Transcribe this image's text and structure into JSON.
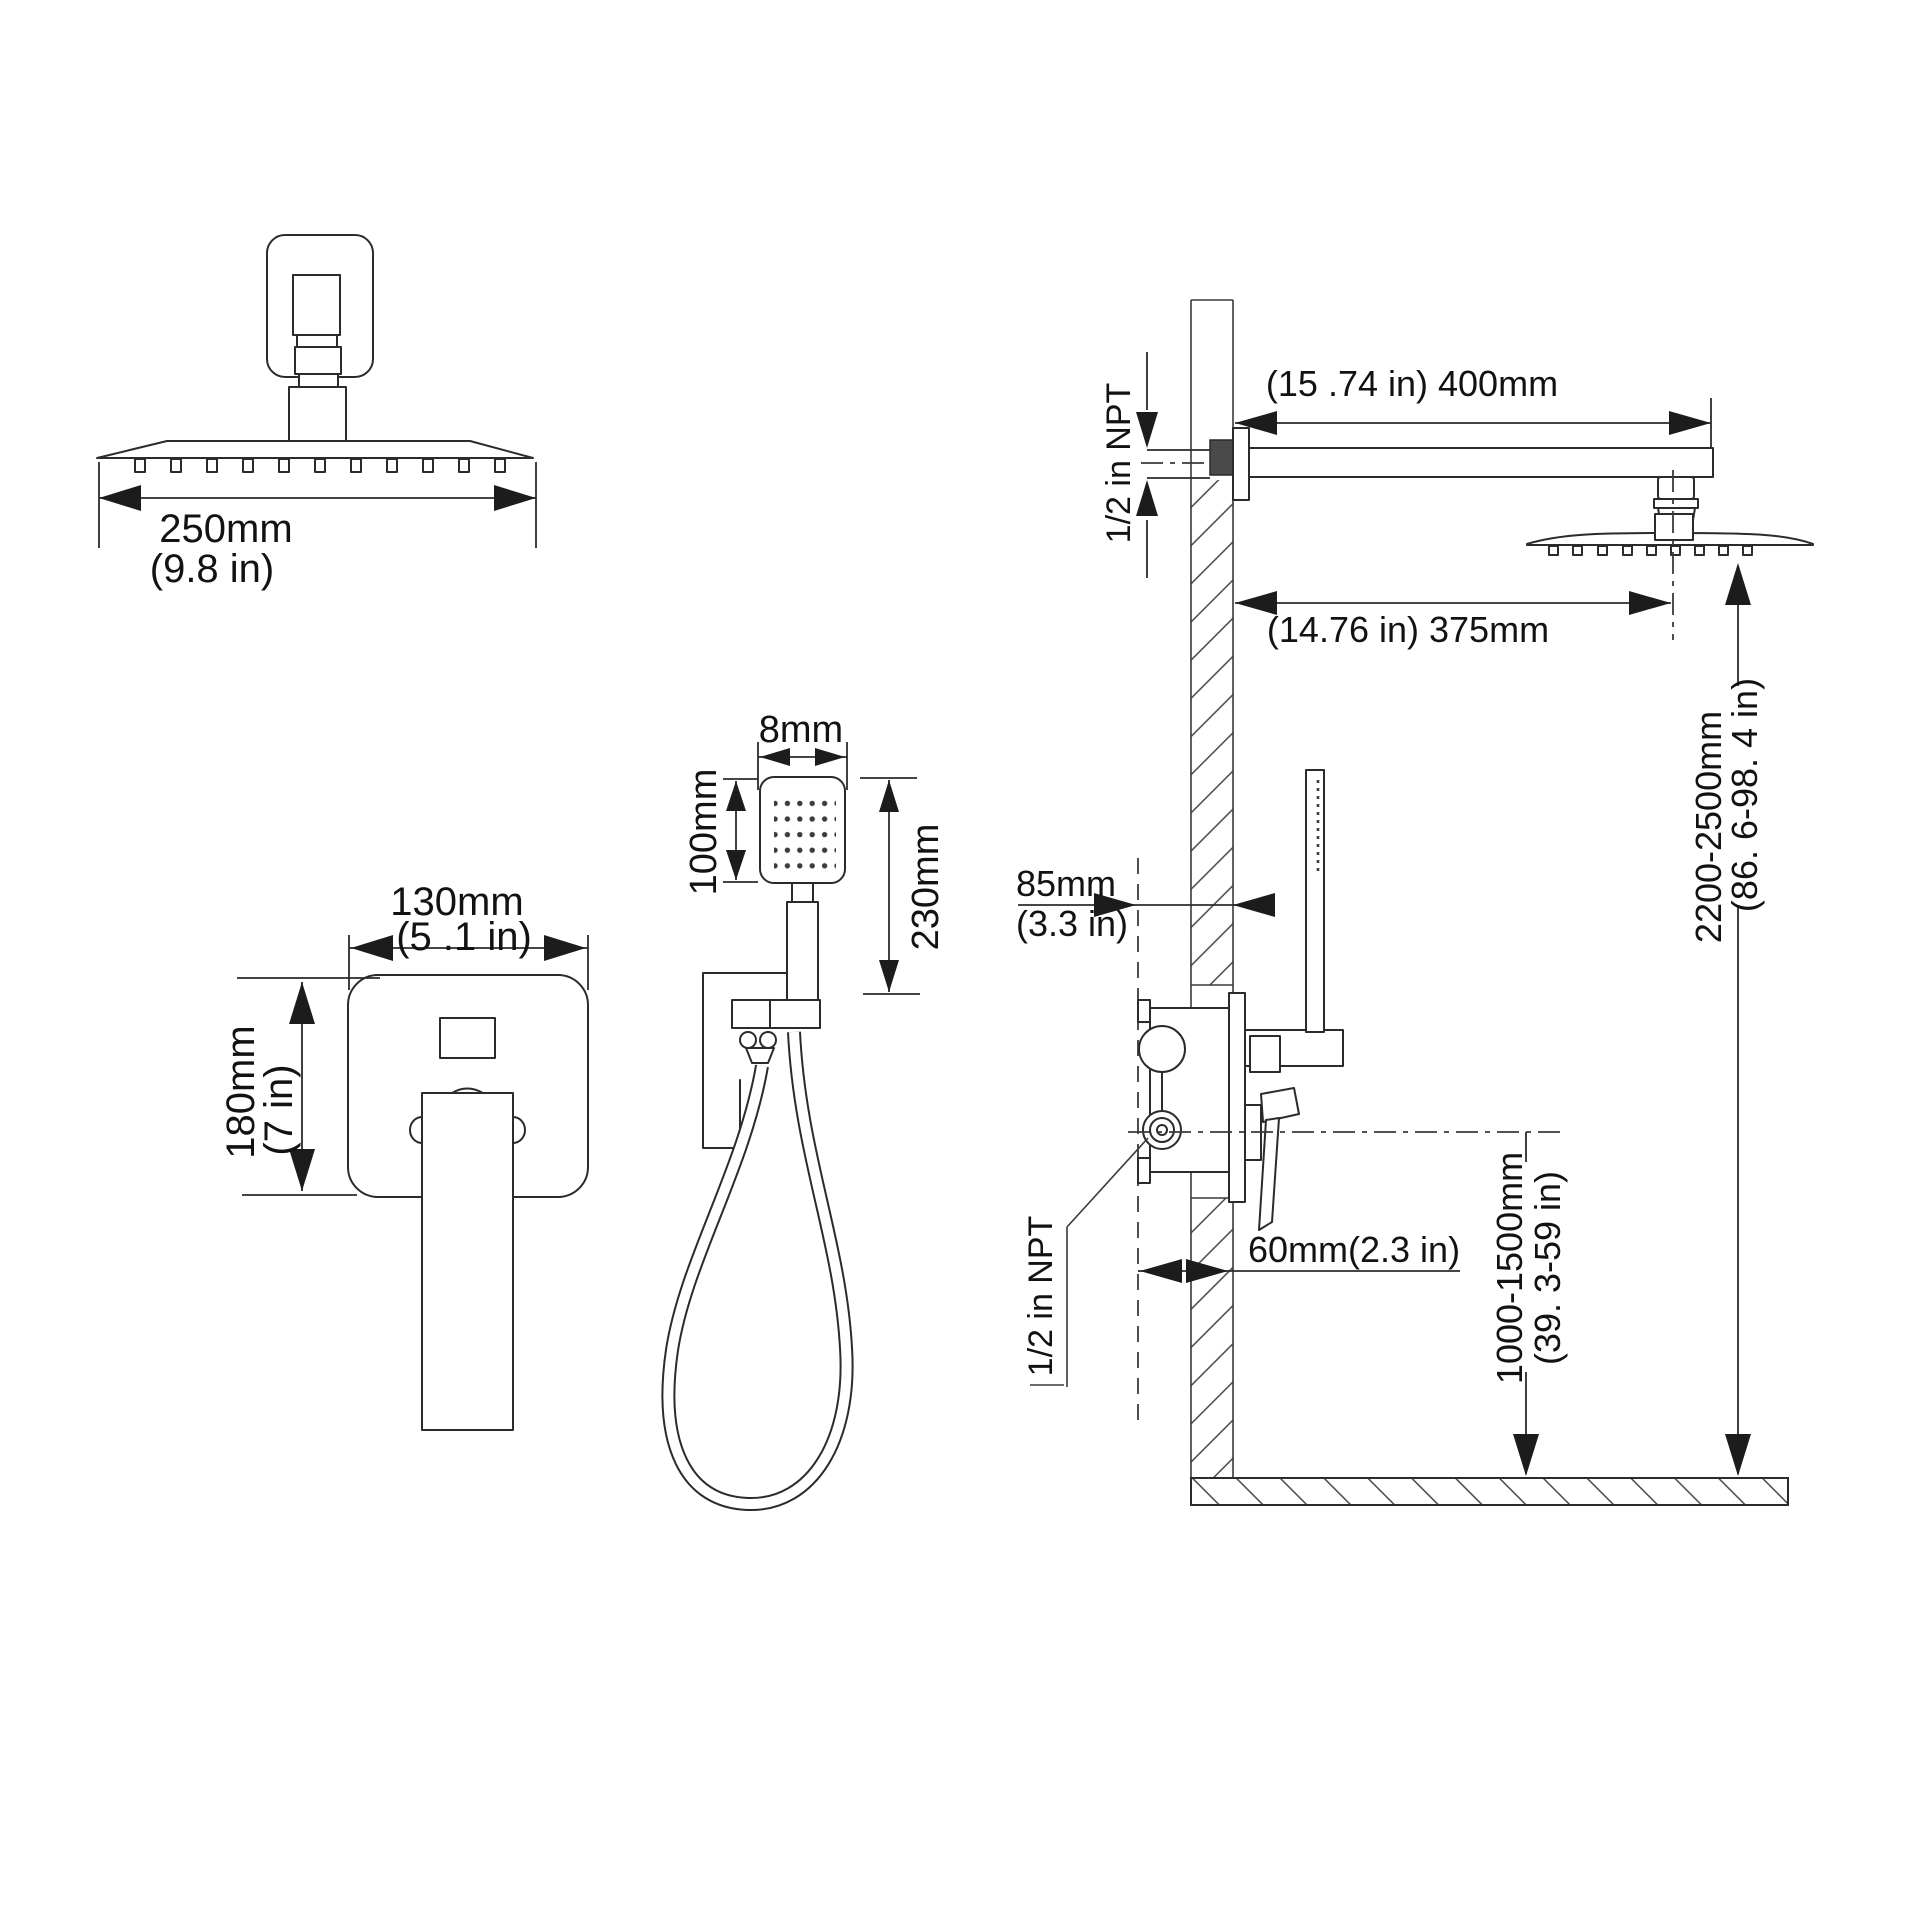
{
  "title": "Shower system installation dimensions diagram",
  "head_top_view": {
    "width_mm": "250mm",
    "width_in": "(9.8 in)"
  },
  "valve_front_view": {
    "width_mm": "130mm",
    "width_in": "(5 .1 in)",
    "height_mm": "180mm",
    "height_in": "(7 in)"
  },
  "hand_shower_view": {
    "face_width": "8mm",
    "face_height": "100mm",
    "overall_length": "230mm"
  },
  "installation_view": {
    "arm_length": "(15 .74 in) 400mm",
    "head_wall_distance": "(14.76 in) 375mm",
    "arm_thread": "1/2 in NPT",
    "valve_rough_depth_mm": "85mm",
    "valve_rough_depth_in": "(3.3 in)",
    "head_height_mm": "2200-2500mm",
    "head_height_in": "(86. 6-98. 4 in)",
    "valve_wall_depth": "60mm(2.3 in)",
    "valve_thread": "1/2 in NPT",
    "valve_height_mm": "1000-1500mm",
    "valve_height_in": "(39. 3-59 in)"
  }
}
